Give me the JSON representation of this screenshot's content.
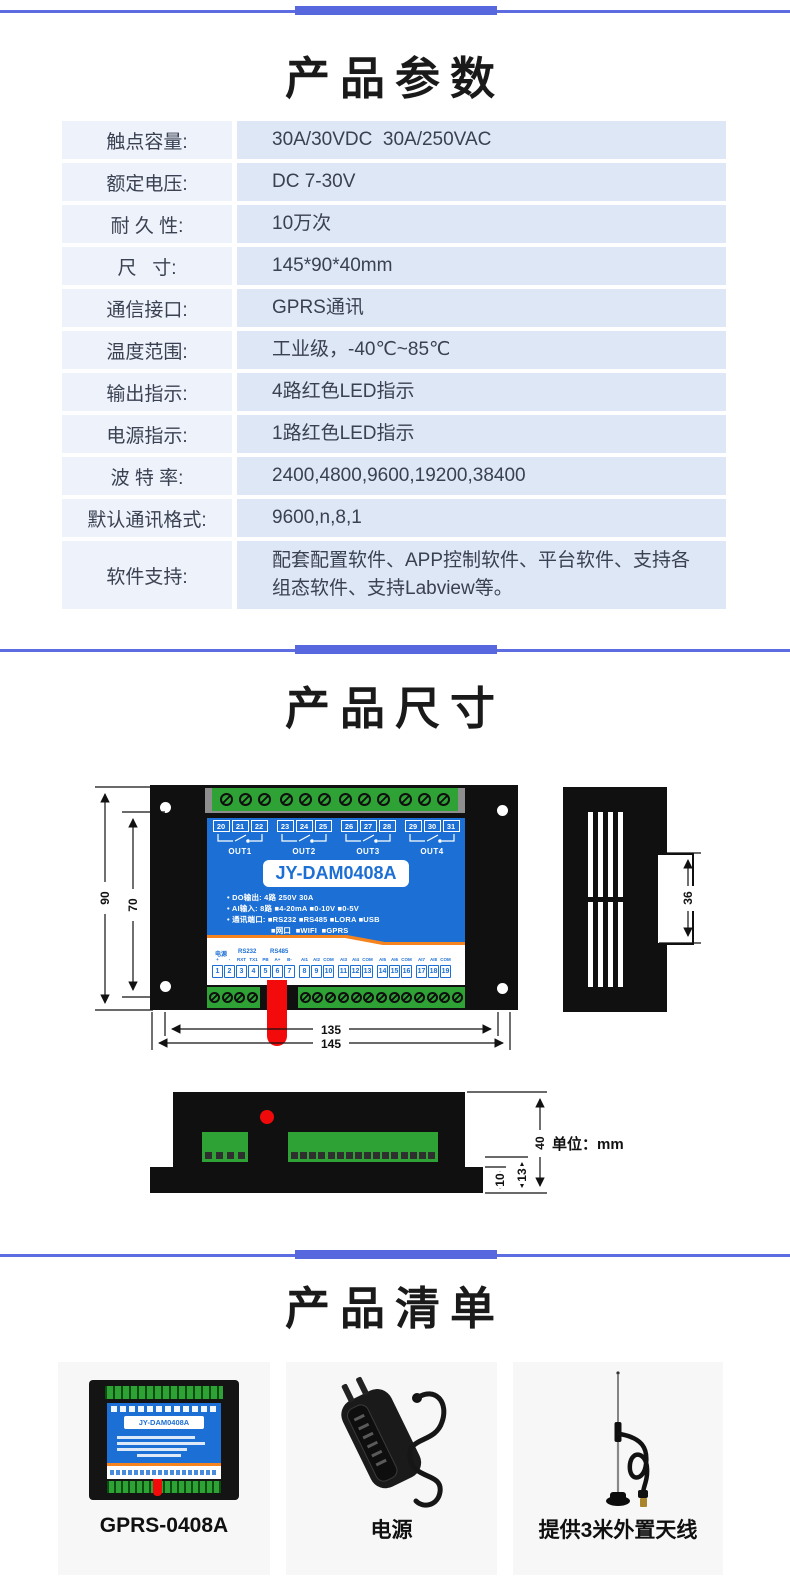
{
  "colors": {
    "divider": "#5d6ce0",
    "panel_blue": "#1c6fd4",
    "orange": "#f5831e",
    "green": "#2ea235",
    "red": "#f30b0b"
  },
  "params": {
    "title": "产品参数",
    "rows": [
      {
        "label": "触点容量:",
        "value": "30A/30VDC  30A/250VAC"
      },
      {
        "label": "额定电压:",
        "value": "DC 7-30V"
      },
      {
        "label": "耐 久 性:",
        "value": "10万次"
      },
      {
        "label": "尺   寸:",
        "value": "145*90*40mm"
      },
      {
        "label": "通信接口:",
        "value": "GPRS通讯"
      },
      {
        "label": "温度范围:",
        "value": "工业级，-40℃~85℃"
      },
      {
        "label": "输出指示:",
        "value": "4路红色LED指示"
      },
      {
        "label": "电源指示:",
        "value": "1路红色LED指示"
      },
      {
        "label": "波 特 率:",
        "value": "2400,4800,9600,19200,38400"
      },
      {
        "label": "默认通讯格式:",
        "value": "9600,n,8,1"
      },
      {
        "label": "软件支持:",
        "value": "配套配置软件、APP控制软件、平台软件、支持各组态软件、支持Labview等。"
      }
    ]
  },
  "size": {
    "title": "产品尺寸",
    "device": {
      "model": "JY-DAM0408A",
      "out_groups": [
        {
          "nums": [
            "20",
            "21",
            "22"
          ],
          "label": "OUT1"
        },
        {
          "nums": [
            "23",
            "24",
            "25"
          ],
          "label": "OUT2"
        },
        {
          "nums": [
            "26",
            "27",
            "28"
          ],
          "label": "OUT3"
        },
        {
          "nums": [
            "29",
            "30",
            "31"
          ],
          "label": "OUT4"
        }
      ],
      "spec_lines": [
        "• DO输出: 4路 250V 30A",
        "• AI输入: 8路 ■4-20mA ■0-10V ■0-5V",
        "• 通讯端口: ■RS232 ■RS485 ■LORA ■USB",
        "■网口  ■WIFI  ■GPRS"
      ],
      "port_headers": {
        "power": "电源",
        "rs232": "RS232",
        "rs485": "RS485"
      },
      "pin_groups": [
        {
          "cols": [
            {
              "p": "+",
              "n": "1"
            },
            {
              "p": "-",
              "n": "2"
            },
            {
              "p": "RXT",
              "n": "3"
            },
            {
              "p": "TX1",
              "n": "4"
            },
            {
              "p": "PB",
              "n": "5"
            },
            {
              "p": "A+",
              "n": "6"
            },
            {
              "p": "B-",
              "n": "7"
            }
          ]
        },
        {
          "cols": [
            {
              "p": "AI1",
              "n": "8"
            },
            {
              "p": "AI2",
              "n": "9"
            },
            {
              "p": "COM",
              "n": "10"
            }
          ]
        },
        {
          "cols": [
            {
              "p": "AI3",
              "n": "11"
            },
            {
              "p": "AI4",
              "n": "12"
            },
            {
              "p": "COM",
              "n": "13"
            }
          ]
        },
        {
          "cols": [
            {
              "p": "AI5",
              "n": "14"
            },
            {
              "p": "AI6",
              "n": "15"
            },
            {
              "p": "COM",
              "n": "16"
            }
          ]
        },
        {
          "cols": [
            {
              "p": "AI7",
              "n": "17"
            },
            {
              "p": "AI8",
              "n": "18"
            },
            {
              "p": "COM",
              "n": "19"
            }
          ]
        }
      ],
      "dims": {
        "height": "90",
        "inner_height": "70",
        "inner_width": "135",
        "width": "145",
        "side": "36",
        "depth": "40",
        "step": "13",
        "flange": "10"
      },
      "unit": "单位：mm"
    }
  },
  "list": {
    "title": "产品清单",
    "items": [
      {
        "label": "GPRS-0408A"
      },
      {
        "label": "电源"
      },
      {
        "label": "提供3米外置天线"
      }
    ]
  }
}
